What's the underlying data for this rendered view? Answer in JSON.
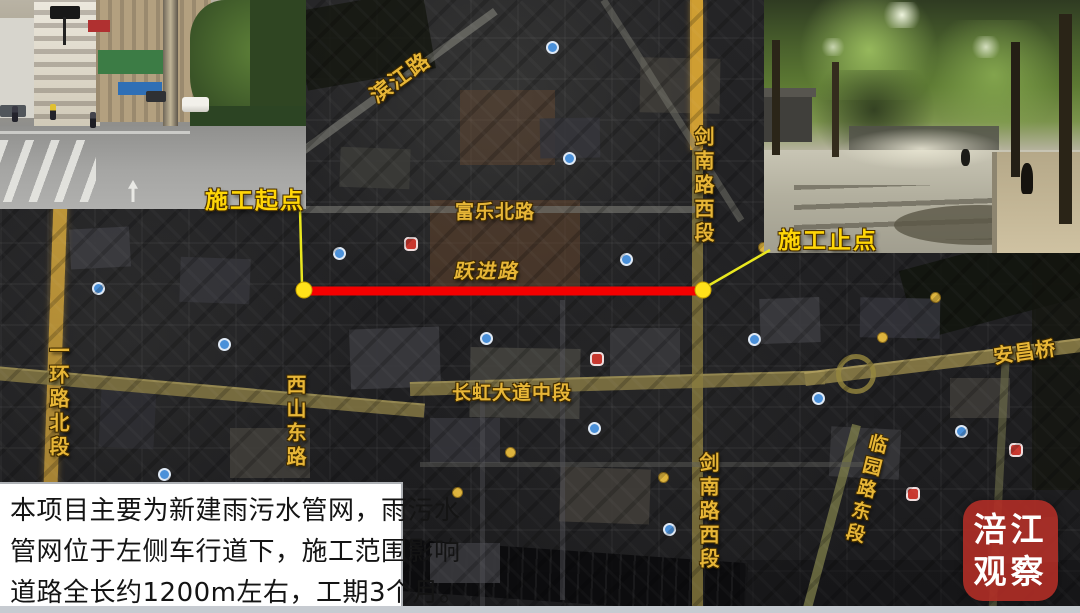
{
  "map": {
    "road_labels": {
      "binjiang": "滨江路",
      "fule_north": "富乐北路",
      "jiannan_west_top": "剑南路西段",
      "yuejin": "跃进路",
      "yihuan_north": "一环路北段",
      "xishan_east": "西山东路",
      "changhong_mid": "长虹大道中段",
      "anchang_bridge": "安昌桥",
      "jiannan_west_bottom": "剑南路西段",
      "linyuan_east": "临园路东段"
    },
    "construction": {
      "start_label": "施工起点",
      "end_label": "施工止点",
      "line_color": "#f40000",
      "marker_color": "#ffe11a",
      "callout_color": "#e9e71f"
    }
  },
  "info_box": {
    "lines": [
      "本项目主要为新建雨污水管网，雨污水",
      "管网位于左侧车行道下，施工范围影响",
      "道路全长约1200m左右，工期3个月。"
    ]
  },
  "logo": {
    "top": "涪江",
    "bottom": "观察",
    "bg_color": "#b2302b"
  },
  "colors": {
    "label_gold": "#e7b637",
    "highlight_yellow": "#ffd608",
    "accent_red": "#f40000"
  }
}
